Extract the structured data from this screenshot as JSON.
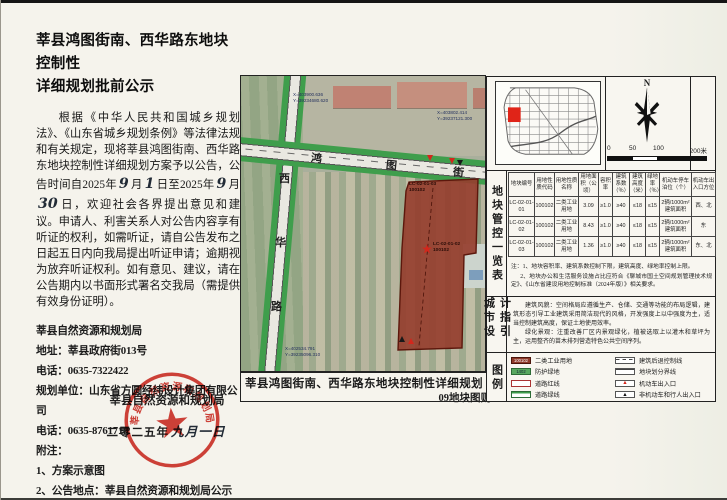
{
  "notice": {
    "title1": "莘县鸿图街南、西华路东地块控制性",
    "title2": "详细规划批前公示",
    "para": {
      "seg1": "根据《中华人民共和国城乡规划法》、《山东省城乡规划条例》等法律法规和有关规定，现将莘县鸿图街南、西华路东地块控制性详细规划方案予以公告，公告时间自2025年",
      "hand1": "9",
      "seg2": "月",
      "hand2": "1",
      "seg3": "日至2025年",
      "hand3": "9",
      "seg4": "月",
      "hand4": "30",
      "seg5": "日，欢迎社会各界提出意见和建议。申请人、利害关系人对公告内容享有听证的权利，如需听证，请自公告发布之日起五日内向我局提出听证申请；逾期视为放弃听证权利。如有意见、建议，请在公告期内以书面形式署名交我局（需提供有效身份证明）。"
    },
    "contact_lines": [
      "莘县自然资源和规划局",
      "地址：莘县政府街013号",
      "电话：0635-7322422",
      "规划单位：山东省方圆经纬设计集团有限公司",
      "电话：0635-8761718",
      "附注：",
      "1、方案示意图",
      "2、公告地点：莘县自然资源和规划局公示栏及网站、项目现场。"
    ],
    "sign_org": "莘县自然资源和规划局",
    "sign_date_prefix": "二零二五年",
    "sign_date_hand": "九月一日",
    "seal_text": "莘县自然资源和规划局"
  },
  "map": {
    "road_h": [
      "鸿",
      "图",
      "街"
    ],
    "road_v": [
      "西",
      "华",
      "路"
    ],
    "coords": [
      {
        "x": "X=403900.636",
        "y": "Y=39234680.620"
      },
      {
        "x": "X=403802.414",
        "y": "Y=39237121.300"
      },
      {
        "x": "X=402534.791",
        "y": "Y=39235096.310"
      }
    ],
    "parcels": [
      {
        "code": "LC-02-01-03",
        "num": "100102"
      },
      {
        "code": "LC-02-01-02",
        "num": "100102"
      }
    ],
    "caption1": "莘县鸿图街南、西华路东地块控制性详细规划",
    "caption2": "09地块图则"
  },
  "panel": {
    "section_labels": {
      "table": "地块管控一览表",
      "design": "城市设计指引",
      "legend": "图例"
    },
    "compass_n": "N",
    "scale_labels": [
      "0",
      "50",
      "100",
      "200米"
    ],
    "table": {
      "headers": [
        "地块编号",
        "用地性质代码",
        "用地性质名称",
        "用地面积（公顷）",
        "容积率",
        "建筑系数（％）",
        "建筑高度（米）",
        "绿地率（％）",
        "机动车停车泊位（个）",
        "机动车出入口方位"
      ],
      "rows": [
        [
          "LC-02-01-01",
          "100102",
          "二类工业用地",
          "3.09",
          "≥1.0",
          "≥40",
          "≤18",
          "≤15",
          "2辆/1000m²建筑面积",
          "西、北"
        ],
        [
          "LC-02-01-02",
          "100102",
          "二类工业用地",
          "8.43",
          "≥1.0",
          "≥40",
          "≤18",
          "≤15",
          "2辆/1000m²建筑面积",
          "东"
        ],
        [
          "LC-02-01-03",
          "100102",
          "二类工业用地",
          "1.36",
          "≥1.0",
          "≥40",
          "≤18",
          "≤15",
          "2辆/1000m²建筑面积",
          "东、北"
        ]
      ]
    },
    "notes": [
      "注：1、地块容积率、建筑系数控制下限，建筑高度、绿地率控制上限。",
      "2、地块办公和生活服务设施占比应符合《聊城市国土空间规划管理技术规定》、《山东省建设用地控制标准（2024年版）》相关要求。"
    ],
    "design_text": [
      "建筑风貌：空间格局应遵循生产、仓储、交通等功能的布局逻辑，建筑形态引导工业建筑采用简洁现代的风格，开发强度上以中强度为主，适当控制建筑高度，保证土地使用效率。",
      "绿化景观：注重改善厂区内景观绿化，植被选取上以灌木和草坪为主，运用整齐的苗木排列营造特色公共空间序列。"
    ],
    "legend": {
      "left": [
        {
          "type": "industrial",
          "code": "100102",
          "label": "二类工业用地"
        },
        {
          "type": "protect-green",
          "code": "1402",
          "label": "防护绿地"
        },
        {
          "type": "road-red",
          "code": "",
          "label": "道路红线"
        },
        {
          "type": "road-green",
          "code": "",
          "label": "道路绿线"
        }
      ],
      "right": [
        {
          "type": "setback",
          "code": "",
          "label": "建筑后退控制线"
        },
        {
          "type": "boundary",
          "code": "",
          "label": "地块划分界线"
        },
        {
          "type": "entry-red",
          "code": "▲",
          "label": "机动车出入口"
        },
        {
          "type": "entry-black",
          "code": "▲",
          "label": "非机动车和行人出入口"
        }
      ]
    }
  },
  "colors": {
    "seal_red": "#cf2920",
    "parcel_fill": "#96402f",
    "road_green": "#3f9e4c"
  }
}
